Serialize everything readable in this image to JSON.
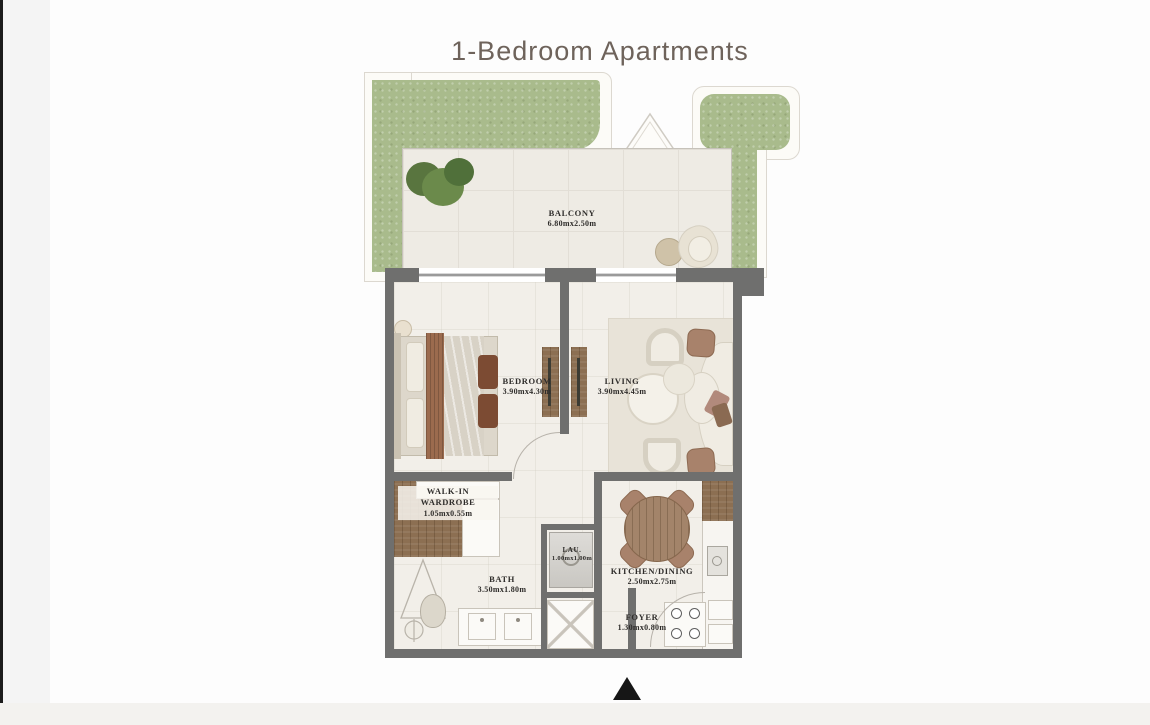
{
  "title": "1-Bedroom Apartments",
  "colors": {
    "page_bg": "#fdfdfd",
    "title_text": "#6e635b",
    "grass_green": "#a9bb8c",
    "wall_gray": "#6f6f6e",
    "wood_brown": "#8c6f52",
    "north_arrow": "#161616"
  },
  "rooms": {
    "balcony": {
      "name": "BALCONY",
      "dims": "6.80mx2.50m"
    },
    "bedroom": {
      "name": "BEDROOM",
      "dims": "3.90mx4.30m"
    },
    "living": {
      "name": "LIVING",
      "dims": "3.90mx4.45m"
    },
    "walk_in_wardrobe": {
      "name_line1": "WALK-IN",
      "name_line2": "WARDROBE",
      "dims": "1.05mx0.55m"
    },
    "bath": {
      "name": "BATH",
      "dims": "3.50mx1.80m"
    },
    "laundry": {
      "name": "LAU.",
      "dims": "1.00mx1.00m"
    },
    "kitchen_dining": {
      "name": "KITCHEN/DINING",
      "dims": "2.50mx2.75m"
    },
    "foyer": {
      "name": "FOYER",
      "dims": "1.30mx0.80m"
    }
  }
}
